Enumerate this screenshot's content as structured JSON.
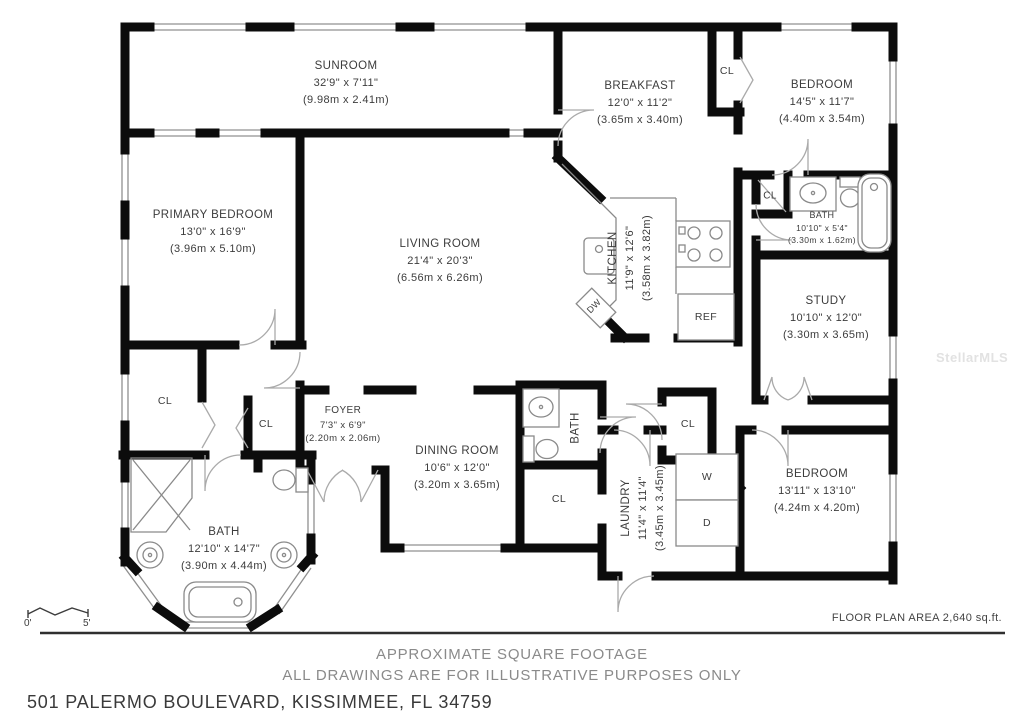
{
  "page": {
    "watermark": "StellarMLS",
    "floor_area_note": "FLOOR PLAN AREA 2,640 sq.ft.",
    "disclaimer_line1": "APPROXIMATE SQUARE FOOTAGE",
    "disclaimer_line2": "ALL DRAWINGS ARE FOR ILLUSTRATIVE PURPOSES ONLY",
    "address": "501 PALERMO BOULEVARD, KISSIMMEE, FL 34759",
    "scale_start": "0'",
    "scale_end": "5'"
  },
  "rooms": [
    {
      "name": "SUNROOM",
      "imperial": "32'9\" x 7'11\"",
      "metric": "(9.98m x 2.41m)"
    },
    {
      "name": "BREAKFAST",
      "imperial": "12'0\" x 11'2\"",
      "metric": "(3.65m x 3.40m)"
    },
    {
      "name": "BEDROOM",
      "imperial": "14'5\" x 11'7\"",
      "metric": "(4.40m x 3.54m)"
    },
    {
      "name": "PRIMARY BEDROOM",
      "imperial": "13'0\" x 16'9\"",
      "metric": "(3.96m x 5.10m)"
    },
    {
      "name": "LIVING ROOM",
      "imperial": "21'4\" x 20'3\"",
      "metric": "(6.56m x 6.26m)"
    },
    {
      "name": "KITCHEN",
      "imperial": "11'9\" x 12'6\"",
      "metric": "(3.58m x 3.82m)"
    },
    {
      "name": "BATH",
      "imperial": "10'10\" x 5'4\"",
      "metric": "(3.30m x 1.62m)"
    },
    {
      "name": "STUDY",
      "imperial": "10'10\" x 12'0\"",
      "metric": "(3.30m x 3.65m)"
    },
    {
      "name": "FOYER",
      "imperial": "7'3\" x 6'9\"",
      "metric": "(2.20m x 2.06m)"
    },
    {
      "name": "DINING ROOM",
      "imperial": "10'6\" x 12'0\"",
      "metric": "(3.20m x 3.65m)"
    },
    {
      "name": "BATH"
    },
    {
      "name": "LAUNDRY",
      "imperial": "11'4\" x 11'4\"",
      "metric": "(3.45m x 3.45m)"
    },
    {
      "name": "BEDROOM",
      "imperial": "13'11\" x 13'10\"",
      "metric": "(4.24m x 4.20m)"
    },
    {
      "name": "BATH",
      "imperial": "12'10\" x 14'7\"",
      "metric": "(3.90m x 4.44m)"
    }
  ],
  "fixture_labels": {
    "closet": "CL",
    "dishwasher": "DW",
    "refrigerator": "REF",
    "washer": "W",
    "dryer": "D"
  }
}
